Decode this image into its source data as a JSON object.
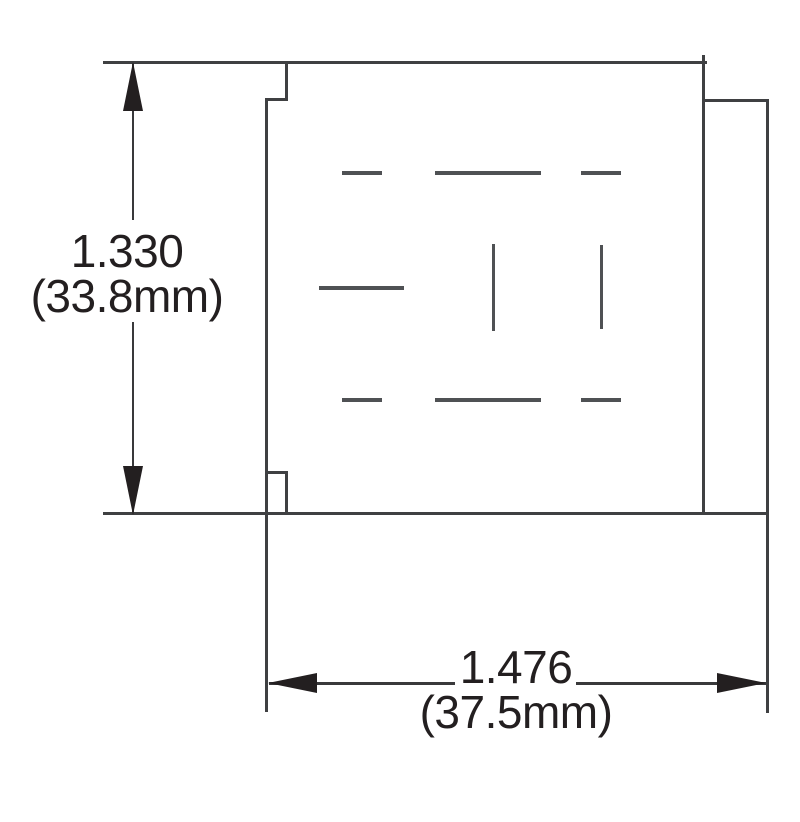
{
  "drawing": {
    "vertical_dimension": {
      "inches": "1.330",
      "metric": "(33.8mm)"
    },
    "horizontal_dimension": {
      "inches": "1.476",
      "metric": "(37.5mm)"
    }
  },
  "colors": {
    "background": "#ffffff",
    "outline": "#3f4042",
    "slot": "#4f5154",
    "dimension_line": "#39393b",
    "arrow_and_text": "#231f20"
  }
}
